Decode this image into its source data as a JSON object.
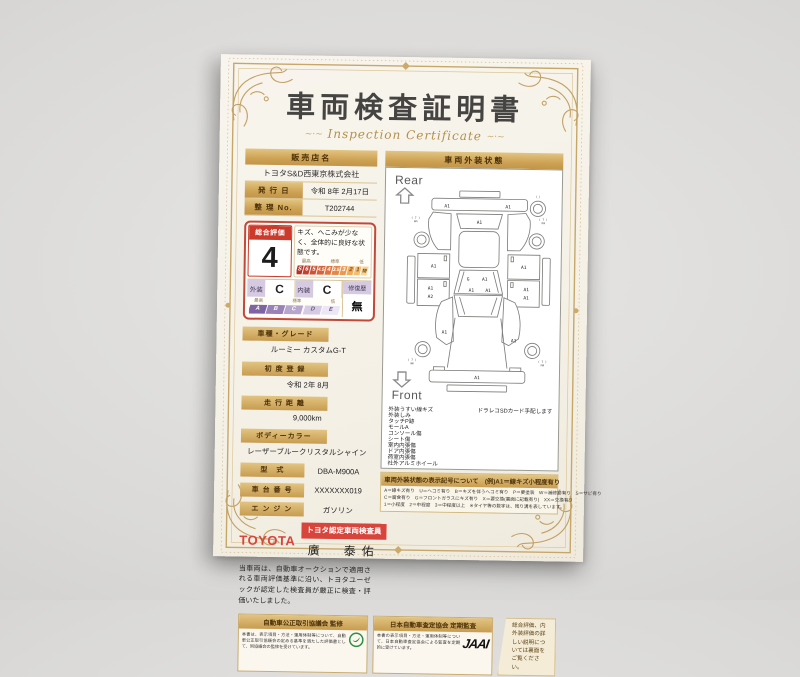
{
  "certificate": {
    "title": "車両検査証明書",
    "subtitle": "Inspection Certificate",
    "ornament": "~·~",
    "dealer": {
      "header": "販売店名",
      "name": "トヨタS&D西東京株式会社"
    },
    "issue": {
      "label": "発 行 日",
      "value": "令和 8年 2月17日"
    },
    "ref_no": {
      "label": "整 理 No.",
      "value": "T202744"
    },
    "evaluation": {
      "overall_label": "総合評価",
      "overall_score": "4",
      "comment": "キズ、へこみが少なく、全体的に良好な状態です。",
      "scale_heads": {
        "high": "最高",
        "mid": "標準",
        "low": "低"
      },
      "score_scale": [
        "S",
        "6",
        "5",
        "4.5",
        "4",
        "3.5",
        "3",
        "2",
        "1",
        "特R"
      ],
      "exterior_label": "外装",
      "exterior_grade": "C",
      "interior_label": "内装",
      "interior_grade": "C",
      "repair_label": "修復歴",
      "repair_value": "無",
      "grade_scale": [
        "A",
        "B",
        "C",
        "D",
        "E"
      ]
    },
    "fields": [
      {
        "label": "車種・グレード",
        "value": "ルーミー カスタムG-T",
        "inline": false
      },
      {
        "label": "初 度 登 録",
        "value": "令和 2年 8月",
        "inline": false
      },
      {
        "label": "走 行 距 離",
        "value": "9,000km",
        "inline": false
      },
      {
        "label": "ボディーカラー",
        "value": "レーザーブルークリスタルシャイン",
        "inline": false
      },
      {
        "label": "型　式",
        "value": "DBA-M900A",
        "inline": true
      },
      {
        "label": "車 台 番 号",
        "value": "XXXXXXX019",
        "inline": true
      },
      {
        "label": "エ ン ジ ン",
        "value": "ガソリン",
        "inline": true
      }
    ],
    "inspector": {
      "brand": "TOYOTA",
      "badge": "トヨタ認定車両検査員",
      "name": "廣　泰佑"
    },
    "disclaimer": "当車両は、自動車オークションで適用される車両評価基準に沿い、トヨタユーゼックが認定した検査員が厳正に検査・評価いたしました。",
    "exterior_panel": {
      "header": "車両外装状態",
      "rear_label": "Rear",
      "front_label": "Front",
      "notes": [
        "外装うすい線キズ",
        "外装しみ",
        "タッチP跡",
        "モールA",
        "コンソール傷",
        "シート傷",
        "室内内張傷",
        "ドア内張傷",
        "荷室内張傷",
        "社外アルミホイール"
      ],
      "side_note": "ドラレコSDカード手配します",
      "marks": [
        {
          "t": "A1",
          "x": 58,
          "y": 27
        },
        {
          "t": "A1",
          "x": 146,
          "y": 27
        },
        {
          "t": "(_)",
          "x": 189,
          "y": 11,
          "s": 1
        },
        {
          "t": "A1",
          "x": 105,
          "y": 50
        },
        {
          "t": "( 7 )",
          "x": 13,
          "y": 44,
          "s": 1
        },
        {
          "t": "mm",
          "x": 13,
          "y": 49,
          "s": 1
        },
        {
          "t": "( 7 )",
          "x": 197,
          "y": 44,
          "s": 1
        },
        {
          "t": "mm",
          "x": 197,
          "y": 49,
          "s": 1
        },
        {
          "t": "A1",
          "x": 40,
          "y": 114
        },
        {
          "t": "A1",
          "x": 170,
          "y": 114
        },
        {
          "t": "A1",
          "x": 36,
          "y": 146
        },
        {
          "t": "A2",
          "x": 36,
          "y": 158
        },
        {
          "t": "A1",
          "x": 174,
          "y": 146
        },
        {
          "t": "A1",
          "x": 174,
          "y": 158
        },
        {
          "t": "G",
          "x": 90,
          "y": 132
        },
        {
          "t": "A1",
          "x": 114,
          "y": 132
        },
        {
          "t": "A1",
          "x": 95,
          "y": 148
        },
        {
          "t": "A1",
          "x": 119,
          "y": 148
        },
        {
          "t": "A1",
          "x": 57,
          "y": 209
        },
        {
          "t": "A1",
          "x": 157,
          "y": 220
        },
        {
          "t": "( 7 )",
          "x": 11,
          "y": 249,
          "s": 1
        },
        {
          "t": "mm",
          "x": 11,
          "y": 254,
          "s": 1
        },
        {
          "t": "( 7 )",
          "x": 199,
          "y": 249,
          "s": 1
        },
        {
          "t": "mm",
          "x": 199,
          "y": 254,
          "s": 1
        },
        {
          "t": "A1",
          "x": 105,
          "y": 274
        }
      ]
    },
    "legend": {
      "header": "車両外装状態の表示記号について　(例)A1＝線キズ小程度有り",
      "lines": [
        "A＝線キズ有り　U＝ヘコミ有り　B＝キズを伴うヘコミ有り　P＝要塗装　W＝補修跡有り　S＝サビ有り",
        "C＝腐食有り　G＝フロントガラスにキズ有り　X＝要交換(裏面に記載有り)　XX＝交換有り",
        "1＝小程度　2＝中程度　3＝中程度以上　※タイヤ等の数字は、残り溝を表しています。"
      ]
    },
    "footer": {
      "fair_trade": {
        "header": "自動車公正取引協議会 監修",
        "body": "本書は、表示項目・方法・運用体制等について、自動車公正取引協議会の定める基準を満たした評価書として、同協議会の監修を受けています。"
      },
      "jaai": {
        "header": "日本自動車査定協会 定期監査",
        "body": "本書の表示項目・方法・運用体制等について、日本自動車査定協会による監査を定期的に受けています。",
        "logo": "JAAI"
      },
      "back_note": "総合評価、内外装評価の詳しい説明については裏面をご覧ください。"
    }
  }
}
